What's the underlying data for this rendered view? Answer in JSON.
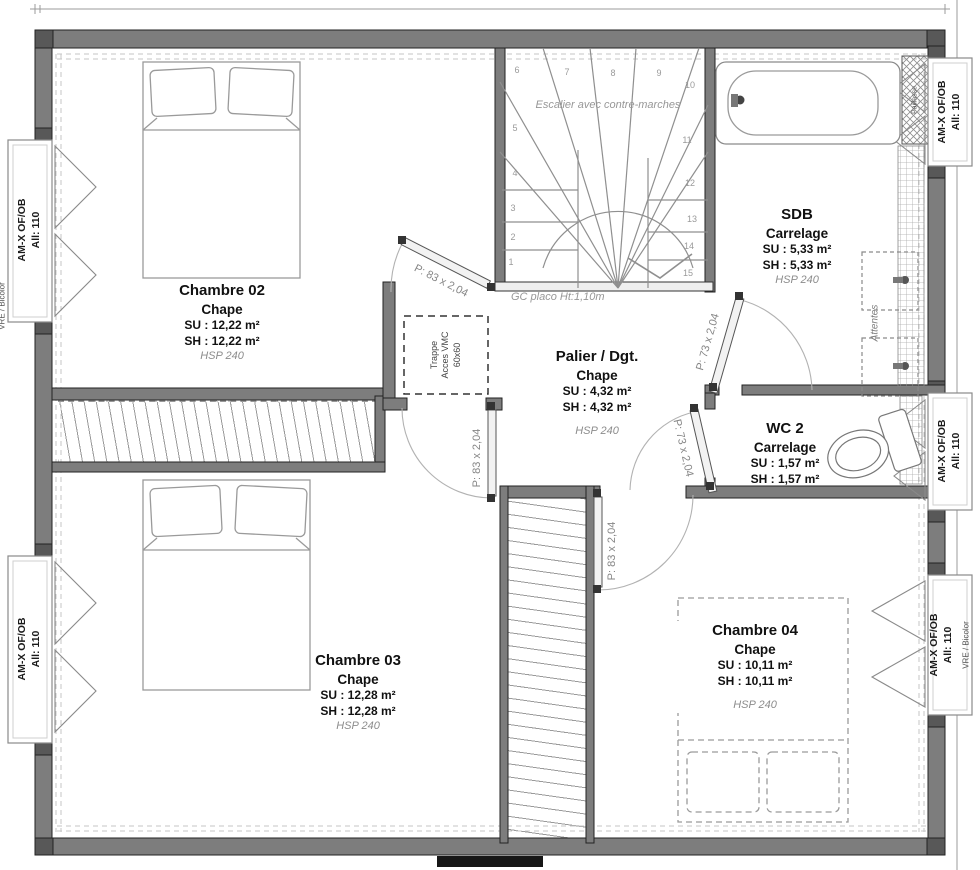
{
  "rooms": {
    "chambre02": {
      "name": "Chambre 02",
      "finish": "Chape",
      "su": "SU : 12,22 m²",
      "sh": "SH : 12,22 m²",
      "hsp": "HSP 240"
    },
    "chambre03": {
      "name": "Chambre 03",
      "finish": "Chape",
      "su": "SU : 12,28 m²",
      "sh": "SH : 12,28 m²",
      "hsp": "HSP 240"
    },
    "chambre04": {
      "name": "Chambre 04",
      "finish": "Chape",
      "su": "SU : 10,11 m²",
      "sh": "SH : 10,11 m²",
      "hsp": "HSP 240"
    },
    "sdb": {
      "name": "SDB",
      "finish": "Carrelage",
      "su": "SU : 5,33 m²",
      "sh": "SH : 5,33 m²",
      "hsp": "HSP 240"
    },
    "wc2": {
      "name": "WC 2",
      "finish": "Carrelage",
      "su": "SU : 1,57 m²",
      "sh": "SH : 1,57 m²"
    },
    "palier": {
      "name": "Palier / Dgt.",
      "finish": "Chape",
      "su": "SU : 4,32 m²",
      "sh": "SH : 4,32 m²",
      "hsp": "HSP 240"
    }
  },
  "stairs": {
    "note": "Escalier avec contre-marches",
    "guard": "GC placo Ht:1,10m",
    "steps": [
      "1",
      "2",
      "3",
      "4",
      "5",
      "6",
      "7",
      "8",
      "9",
      "10",
      "11",
      "12",
      "13",
      "14",
      "15"
    ]
  },
  "doors": {
    "p83": "P: 83 x 2,04",
    "p73": "P: 73 x 2,04"
  },
  "annotations": {
    "trappe_line1": "Trappe",
    "trappe_line2": "Acces VMC",
    "trappe_line3": "60x60",
    "attentes": "Attentes",
    "paillasse": "Paillasse"
  },
  "window_tag": {
    "line1": "AM-X OF/OB",
    "line2": "All: 110"
  },
  "edge_tags": {
    "vre": "VRE / Bicolor"
  },
  "colors": {
    "wall": "#7d7d7d",
    "wall_dark": "#585858",
    "line": "#8f8f8f",
    "muted_text": "#8c8c8c"
  }
}
